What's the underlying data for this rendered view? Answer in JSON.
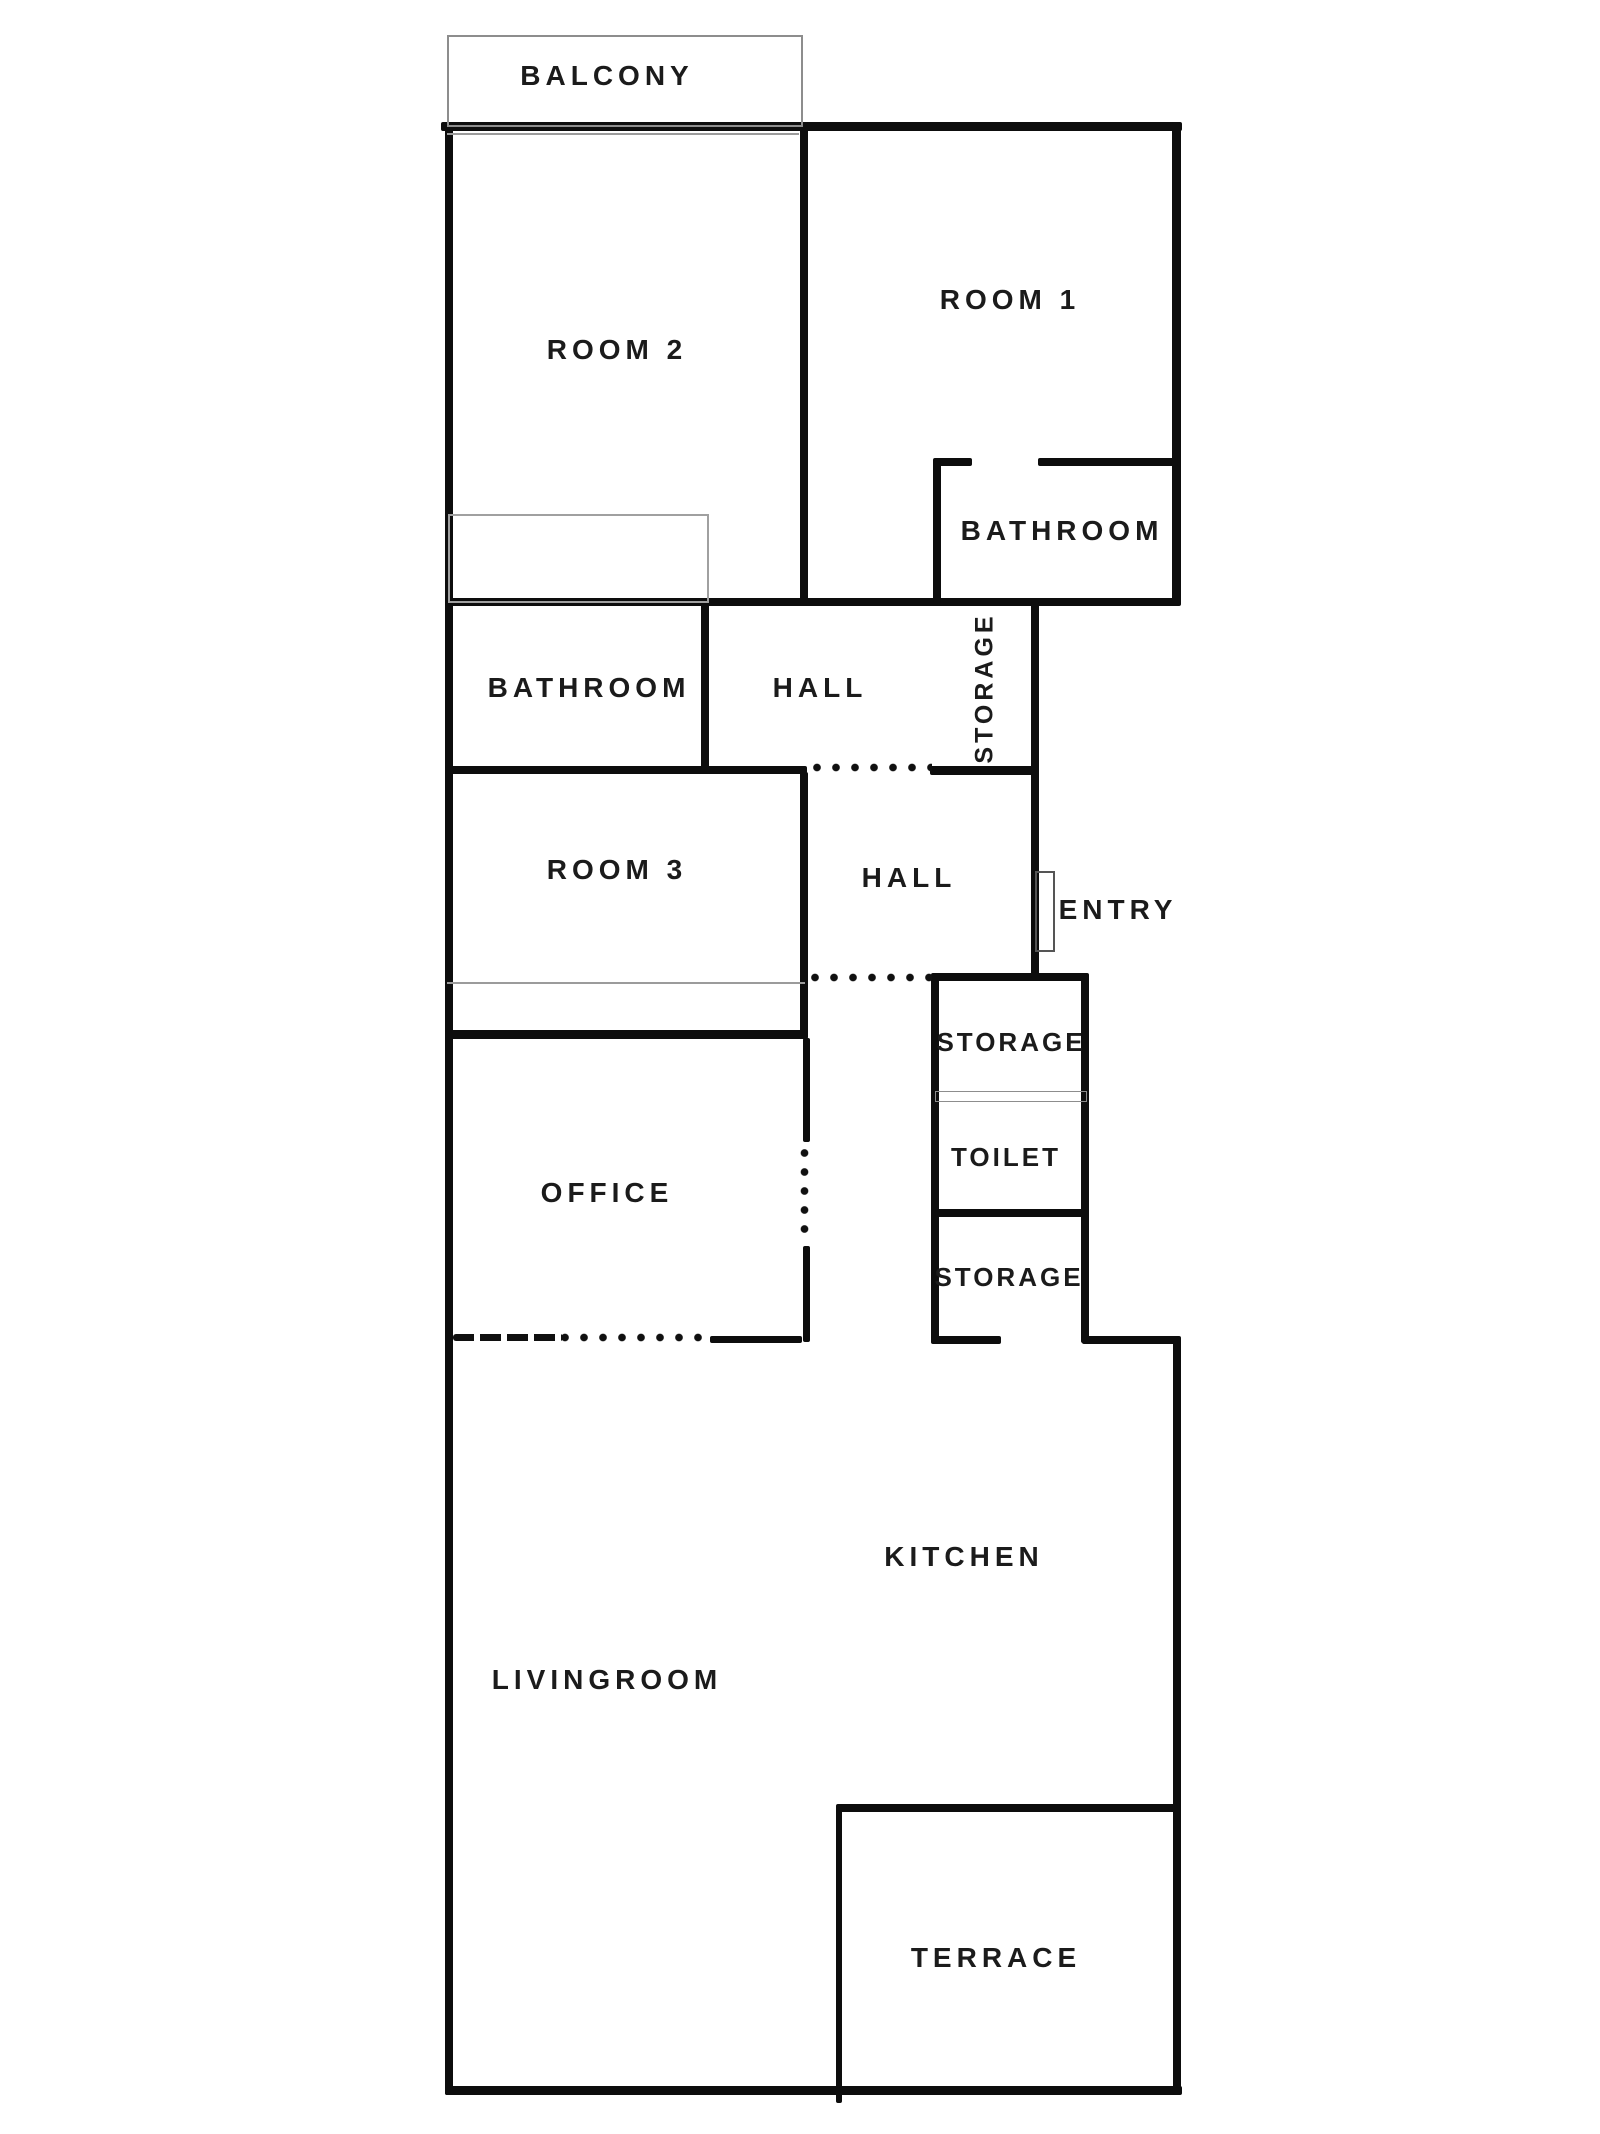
{
  "plan": {
    "background": "#ffffff",
    "wall_color": "#0d0d0d",
    "thin_outline_color": "#9b9b9b",
    "door_outline_color": "#555555",
    "rooms": [
      {
        "id": "balcony",
        "label": "BALCONY",
        "cx": 607,
        "cy": 76,
        "style": ""
      },
      {
        "id": "room2",
        "label": "ROOM 2",
        "cx": 617,
        "cy": 350,
        "style": ""
      },
      {
        "id": "room1",
        "label": "ROOM 1",
        "cx": 1010,
        "cy": 300,
        "style": ""
      },
      {
        "id": "bathroom-right",
        "label": "BATHROOM",
        "cx": 1062,
        "cy": 531,
        "style": ""
      },
      {
        "id": "bathroom-left",
        "label": "BATHROOM",
        "cx": 589,
        "cy": 688,
        "style": ""
      },
      {
        "id": "hall-upper",
        "label": "HALL",
        "cx": 820,
        "cy": 688,
        "style": ""
      },
      {
        "id": "storage-upper",
        "label": "STORAGE",
        "cx": 985,
        "cy": 688,
        "style": "vertical"
      },
      {
        "id": "room3",
        "label": "ROOM 3",
        "cx": 617,
        "cy": 870,
        "style": ""
      },
      {
        "id": "hall-lower",
        "label": "HALL",
        "cx": 909,
        "cy": 878,
        "style": ""
      },
      {
        "id": "entry",
        "label": "ENTRY",
        "cx": 1118,
        "cy": 910,
        "style": ""
      },
      {
        "id": "storage-mid",
        "label": "STORAGE",
        "cx": 1011,
        "cy": 1042,
        "style": "small"
      },
      {
        "id": "toilet",
        "label": "TOILET",
        "cx": 1006,
        "cy": 1157,
        "style": "small"
      },
      {
        "id": "storage-low",
        "label": "STORAGE",
        "cx": 1009,
        "cy": 1277,
        "style": "small"
      },
      {
        "id": "office",
        "label": "OFFICE",
        "cx": 607,
        "cy": 1193,
        "style": ""
      },
      {
        "id": "kitchen",
        "label": "KITCHEN",
        "cx": 964,
        "cy": 1557,
        "style": ""
      },
      {
        "id": "livingroom",
        "label": "LIVINGROOM",
        "cx": 607,
        "cy": 1680,
        "style": ""
      },
      {
        "id": "terrace",
        "label": "TERRACE",
        "cx": 996,
        "cy": 1958,
        "style": ""
      }
    ],
    "walls": [
      {
        "name": "outer-top",
        "x": 441,
        "y": 122,
        "w": 741,
        "h": 9
      },
      {
        "name": "outer-left",
        "x": 445,
        "y": 122,
        "w": 8,
        "h": 1973
      },
      {
        "name": "outer-right-upper",
        "x": 1172,
        "y": 122,
        "w": 9,
        "h": 484
      },
      {
        "name": "outer-bottom",
        "x": 445,
        "y": 2086,
        "w": 737,
        "h": 9
      },
      {
        "name": "outer-right-lower",
        "x": 1173,
        "y": 1336,
        "w": 8,
        "h": 759
      },
      {
        "name": "divider-room1-room2",
        "x": 800,
        "y": 122,
        "w": 8,
        "h": 484
      },
      {
        "name": "band-wall-y600",
        "x": 445,
        "y": 598,
        "w": 733,
        "h": 8
      },
      {
        "name": "bath-right-top-a",
        "x": 933,
        "y": 458,
        "w": 39,
        "h": 8
      },
      {
        "name": "bath-right-top-b",
        "x": 1038,
        "y": 458,
        "w": 140,
        "h": 8
      },
      {
        "name": "bath-right-left-wall",
        "x": 933,
        "y": 462,
        "w": 8,
        "h": 140
      },
      {
        "name": "bath-hall-divider",
        "x": 701,
        "y": 602,
        "w": 8,
        "h": 170
      },
      {
        "name": "wall-y770-left",
        "x": 445,
        "y": 766,
        "w": 362,
        "h": 8
      },
      {
        "name": "storage-upper-bottom",
        "x": 930,
        "y": 766,
        "w": 107,
        "h": 9
      },
      {
        "name": "entry-wall",
        "x": 1031,
        "y": 602,
        "w": 8,
        "h": 377
      },
      {
        "name": "room3-right-wall",
        "x": 800,
        "y": 772,
        "w": 8,
        "h": 266
      },
      {
        "name": "room3-bottom-wall",
        "x": 445,
        "y": 1030,
        "w": 363,
        "h": 9
      },
      {
        "name": "storage-col-left",
        "x": 931,
        "y": 977,
        "w": 8,
        "h": 366
      },
      {
        "name": "storage-col-right",
        "x": 1081,
        "y": 977,
        "w": 8,
        "h": 366
      },
      {
        "name": "storage-col-top",
        "x": 931,
        "y": 973,
        "w": 158,
        "h": 8
      },
      {
        "name": "toilet-bottom",
        "x": 935,
        "y": 1209,
        "w": 150,
        "h": 8
      },
      {
        "name": "kitchen-top-seg-a",
        "x": 931,
        "y": 1336,
        "w": 70,
        "h": 8
      },
      {
        "name": "kitchen-top-seg-b",
        "x": 1082,
        "y": 1336,
        "w": 96,
        "h": 8
      },
      {
        "name": "terrace-top",
        "x": 837,
        "y": 1804,
        "w": 343,
        "h": 8
      },
      {
        "name": "terrace-left",
        "x": 836,
        "y": 1804,
        "w": 6,
        "h": 299
      },
      {
        "name": "office-right-dash-a",
        "x": 803,
        "y": 1038,
        "w": 7,
        "h": 104
      },
      {
        "name": "office-right-dash-b",
        "x": 803,
        "y": 1246,
        "w": 7,
        "h": 96
      },
      {
        "name": "office-bottom-solid",
        "x": 710,
        "y": 1336,
        "w": 92,
        "h": 7
      }
    ],
    "thin_rects": [
      {
        "name": "balcony-outline",
        "x": 447,
        "y": 35,
        "w": 352,
        "h": 88,
        "stroke": 2,
        "color": "#8d8d8d"
      },
      {
        "name": "room2-closet",
        "x": 448,
        "y": 514,
        "w": 257,
        "h": 85,
        "stroke": 2,
        "color": "#a0a0a0"
      },
      {
        "name": "entry-door",
        "x": 1035,
        "y": 871,
        "w": 16,
        "h": 77,
        "stroke": 2,
        "color": "#555555"
      },
      {
        "name": "toilet-shelf",
        "x": 935,
        "y": 1091,
        "w": 150,
        "h": 9,
        "stroke": 1.5,
        "color": "#8d8d8d"
      }
    ],
    "thin_lines": [
      {
        "name": "balcony-window-line",
        "x": 447,
        "y": 133,
        "w": 352,
        "h": 2,
        "color": "#9b9b9b"
      },
      {
        "name": "room3-strip-line",
        "x": 447,
        "y": 982,
        "w": 358,
        "h": 2,
        "color": "#9b9b9b"
      }
    ],
    "dot_rows": [
      {
        "name": "hall-passage-dots-upper",
        "x": 812,
        "y": 763,
        "len": 120
      },
      {
        "name": "hall-passage-dots-lower",
        "x": 810,
        "y": 973,
        "len": 122
      },
      {
        "name": "office-bottom-dots",
        "x": 560,
        "y": 1333,
        "len": 148
      }
    ],
    "dot_cols": [
      {
        "name": "office-right-dots",
        "x": 800,
        "y": 1148,
        "len": 92
      }
    ],
    "scallops": [
      {
        "name": "office-bottom-dashes",
        "x": 453,
        "y": 1334,
        "w": 110,
        "h": 7
      }
    ]
  }
}
